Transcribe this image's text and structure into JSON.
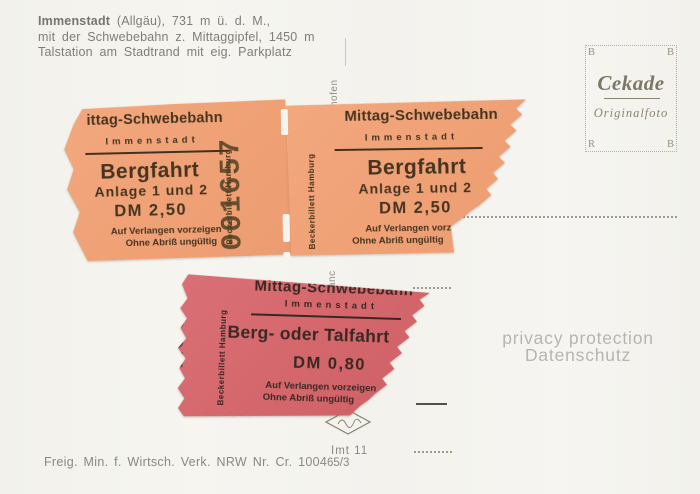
{
  "card": {
    "description_bold": "Immenstadt",
    "description_line1_rest": " (Allgäu), 731 m ü. d. M.,",
    "description_line2": "mit der Schwebebahn z. Mittaggipfel, 1450 m",
    "description_line3": "Talstation am Stadtrand mit eig. Parkplatz",
    "divider_fragment_top": "hofen",
    "divider_fragment_bottom": "anc",
    "license_note": "Freig. Min. f. Wirtsch. Verk. NRW Nr. Cr. 1004",
    "imprint_line1": "Imt 11",
    "imprint_line2": "65/3"
  },
  "stamp_box": {
    "corner_top_left": "B",
    "corner_top_right": "B",
    "corner_bottom_left": "R",
    "corner_bottom_right": "B",
    "brand": "Cekade",
    "subtitle": "Originalfoto"
  },
  "watermark": {
    "line1": "privacy protection",
    "line2": "Datenschutz"
  },
  "colors": {
    "orange_ticket": "#f0a277",
    "pink_ticket": "#d5686d",
    "card_background": "#f5f4ef"
  },
  "tickets": [
    {
      "title": "ittag-Schwebebahn",
      "place": "Immenstadt",
      "fare_type": "Bergfahrt",
      "fare_detail": "Anlage 1 und 2",
      "price": "DM 2,50",
      "note1": "Auf Verlangen vorzeigen",
      "note2": "Ohne Abriß ungültig",
      "serial": "001657",
      "printer": "Beckerbillett Hamburg"
    },
    {
      "title": "Mittag-Schwebebahn",
      "place": "Immenstadt",
      "fare_type": "Bergfahrt",
      "fare_detail": "Anlage 1 und 2",
      "price": "DM 2,50",
      "note1": "Auf Verlangen vorzeigen",
      "note2": "Ohne Abriß ungültig",
      "serial": "001656",
      "printer": "Beckerbillett Hamburg"
    },
    {
      "title": "Mittag-Schwebebahn",
      "place": "Immenstadt",
      "fare_type": "Berg- oder Talfahrt",
      "fare_detail": "",
      "price": "DM 0,80",
      "note1": "Auf Verlangen vorzeigen",
      "note2": "Ohne Abriß ungültig",
      "serial": "001534",
      "printer": "Beckerbillett Hamburg"
    }
  ]
}
